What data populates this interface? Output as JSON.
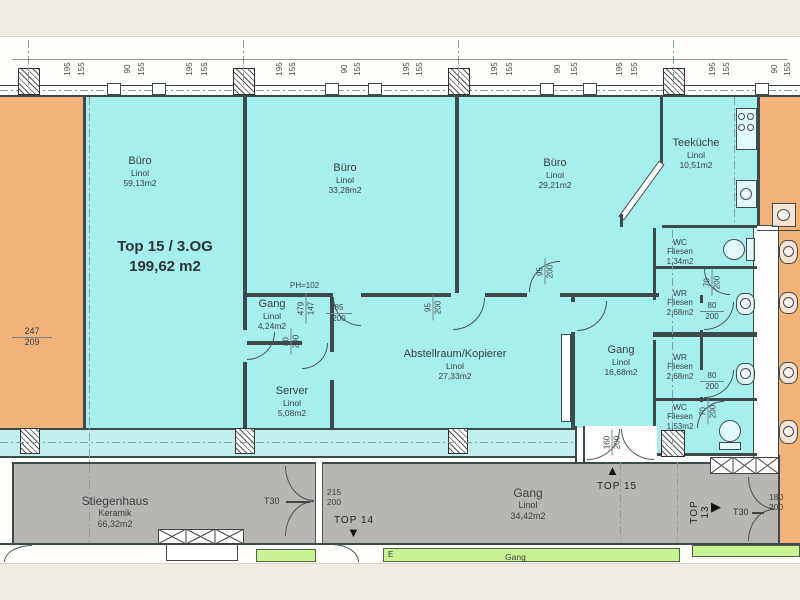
{
  "title": {
    "line1": "Top 15 / 3.OG",
    "line2": "199,62 m2"
  },
  "rooms": {
    "buero1": {
      "name": "Büro",
      "material": "Linol",
      "area": "59,13m2"
    },
    "buero2": {
      "name": "Büro",
      "material": "Linol",
      "area": "33,28m2"
    },
    "buero3": {
      "name": "Büro",
      "material": "Linol",
      "area": "29,21m2"
    },
    "teekueche": {
      "name": "Teeküche",
      "material": "Linol",
      "area": "10,51m2"
    },
    "gang_top": {
      "name": "Gang",
      "material": "Linol",
      "area": "4,24m2"
    },
    "server": {
      "name": "Server",
      "material": "Linol",
      "area": "5,08m2"
    },
    "abstellraum": {
      "name": "Abstellraum/Kopierer",
      "material": "Linol",
      "area": "27,33m2"
    },
    "gang_mid": {
      "name": "Gang",
      "material": "Linol",
      "area": "16,68m2"
    },
    "wc_top": {
      "name": "WC",
      "material": "Fliesen",
      "area": "1,34m2"
    },
    "wr_top": {
      "name": "WR",
      "material": "Fliesen",
      "area": "2,68m2"
    },
    "wr_bottom": {
      "name": "WR",
      "material": "Fliesen",
      "area": "2,68m2"
    },
    "wc_bottom": {
      "name": "WC",
      "material": "Fliesen",
      "area": "1,53m2"
    },
    "stiegenhaus": {
      "name": "Stiegenhaus",
      "material": "Keramik",
      "area": "66,32m2"
    },
    "gang_corridor": {
      "name": "Gang",
      "material": "Linol",
      "area": "34,42m2"
    },
    "gang_south": {
      "name": "Gang"
    },
    "room_e": {
      "name": "E"
    }
  },
  "units": {
    "top13": "TOP 13",
    "top14": "TOP 14",
    "top15": "TOP 15"
  },
  "icons": {
    "top13_arrow": "▶",
    "top14_arrow": "▼",
    "top15_arrow": "▲"
  },
  "doors": {
    "t30_left": {
      "label": "T30",
      "width": "215",
      "height": "200"
    },
    "t30_right": {
      "label": "T30",
      "width": "180",
      "height": "200"
    },
    "entry_top15": {
      "width": "160",
      "height": "200"
    },
    "gang_door_85": {
      "width": "85",
      "height": "200"
    },
    "buero1_door": {
      "width": "80",
      "height": "200"
    },
    "abstell_door": {
      "width": "95",
      "height": "200"
    },
    "buero3_door": {
      "width": "95",
      "height": "200"
    },
    "wc_top_door": {
      "width": "70",
      "height": "200"
    },
    "wr_top_door": {
      "width": "80",
      "height": "200"
    },
    "wr_bottom_door": {
      "width": "80",
      "height": "200"
    },
    "wc_bottom_door": {
      "width": "70",
      "height": "200"
    }
  },
  "annotations": {
    "ph": "PH=102",
    "window_left": {
      "width": "247",
      "height": "209"
    },
    "gang_top_dims": {
      "a": "479",
      "b": "147"
    }
  },
  "dims_top": [
    "195",
    "155",
    "90",
    "155",
    "195",
    "155",
    "195",
    "155",
    "90",
    "155",
    "195",
    "155",
    "195",
    "155",
    "90",
    "155",
    "195",
    "155",
    "195",
    "155",
    "90",
    "155"
  ]
}
